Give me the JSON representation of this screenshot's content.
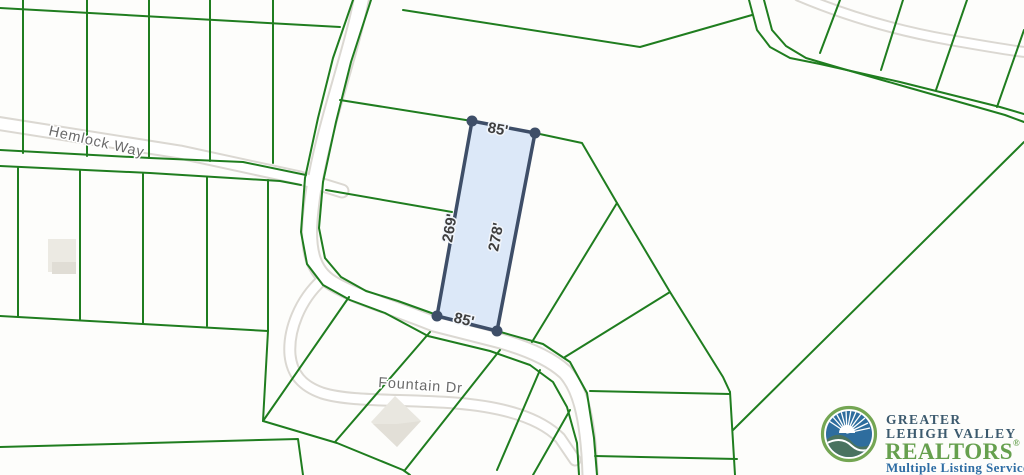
{
  "map": {
    "type": "parcel-plat-map",
    "streets": [
      {
        "name": "Hemlock Way"
      },
      {
        "name": "Fountain Dr"
      }
    ],
    "highlighted_parcel": {
      "dimensions": {
        "top": "85'",
        "left": "269'",
        "right": "278'",
        "bottom": "85'"
      },
      "fill_color": "#d9e6f7",
      "border_color": "#3e4e68"
    },
    "colors": {
      "parcel_line": "#1f7d1f",
      "road_edge": "#dbd8d2",
      "background": "#fdfdfb"
    }
  },
  "logo": {
    "line1": "GREATER",
    "line2": "LEHIGH VALLEY",
    "line3": "REALTORS",
    "registered": "®",
    "tagline": "Multiple Listing Service",
    "colors": {
      "navy": "#3c5a6e",
      "green": "#66a04e",
      "blue": "#2e6da4"
    },
    "emblem": "sunrise-over-hills-icon"
  }
}
